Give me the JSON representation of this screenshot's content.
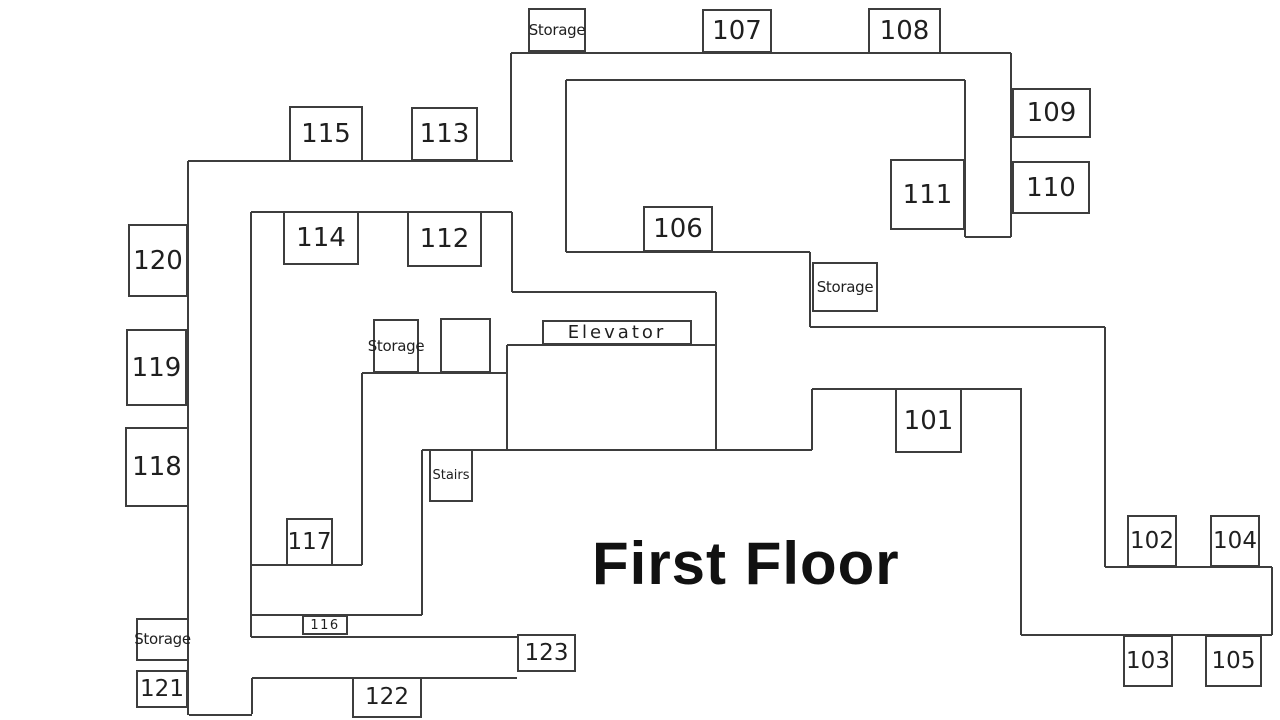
{
  "title": "First Floor",
  "colors": {
    "wall": "#3d3d3d",
    "background": "#ffffff",
    "text": "#1f1f1f"
  },
  "rooms": [
    {
      "id": "storage-top",
      "label": "Storage",
      "variant": "txt",
      "x": 528,
      "y": 8,
      "w": 58,
      "h": 44
    },
    {
      "id": "room-107",
      "label": "107",
      "variant": "num",
      "x": 702,
      "y": 9,
      "w": 70,
      "h": 44
    },
    {
      "id": "room-108",
      "label": "108",
      "variant": "num",
      "x": 868,
      "y": 8,
      "w": 73,
      "h": 46
    },
    {
      "id": "room-109",
      "label": "109",
      "variant": "num",
      "x": 1012,
      "y": 88,
      "w": 79,
      "h": 50
    },
    {
      "id": "room-110",
      "label": "110",
      "variant": "num",
      "x": 1012,
      "y": 161,
      "w": 78,
      "h": 53
    },
    {
      "id": "room-111",
      "label": "111",
      "variant": "num",
      "x": 890,
      "y": 159,
      "w": 75,
      "h": 71
    },
    {
      "id": "room-115",
      "label": "115",
      "variant": "num",
      "x": 289,
      "y": 106,
      "w": 74,
      "h": 56
    },
    {
      "id": "room-113",
      "label": "113",
      "variant": "num",
      "x": 411,
      "y": 107,
      "w": 67,
      "h": 54
    },
    {
      "id": "room-114",
      "label": "114",
      "variant": "num",
      "x": 283,
      "y": 211,
      "w": 76,
      "h": 54
    },
    {
      "id": "room-112",
      "label": "112",
      "variant": "num",
      "x": 407,
      "y": 211,
      "w": 75,
      "h": 56
    },
    {
      "id": "room-106",
      "label": "106",
      "variant": "num",
      "x": 643,
      "y": 206,
      "w": 70,
      "h": 46
    },
    {
      "id": "room-120",
      "label": "120",
      "variant": "num",
      "x": 128,
      "y": 224,
      "w": 60,
      "h": 73
    },
    {
      "id": "room-119",
      "label": "119",
      "variant": "num",
      "x": 126,
      "y": 329,
      "w": 61,
      "h": 77
    },
    {
      "id": "room-118",
      "label": "118",
      "variant": "num",
      "x": 125,
      "y": 427,
      "w": 64,
      "h": 80
    },
    {
      "id": "storage-right",
      "label": "Storage",
      "variant": "txt",
      "x": 812,
      "y": 262,
      "w": 66,
      "h": 50
    },
    {
      "id": "storage-middle",
      "label": "Storage",
      "variant": "txt",
      "x": 373,
      "y": 319,
      "w": 46,
      "h": 54
    },
    {
      "id": "unlabeled-box",
      "label": "",
      "variant": "txt",
      "x": 440,
      "y": 318,
      "w": 51,
      "h": 55
    },
    {
      "id": "elevator",
      "label": "Elevator",
      "variant": "elev",
      "x": 542,
      "y": 320,
      "w": 150,
      "h": 25
    },
    {
      "id": "stairs",
      "label": "Stairs",
      "variant": "txt-sm",
      "x": 429,
      "y": 449,
      "w": 44,
      "h": 53
    },
    {
      "id": "room-101",
      "label": "101",
      "variant": "num",
      "x": 895,
      "y": 388,
      "w": 67,
      "h": 65
    },
    {
      "id": "room-117",
      "label": "117",
      "variant": "num-sm",
      "x": 286,
      "y": 518,
      "w": 47,
      "h": 48
    },
    {
      "id": "room-102",
      "label": "102",
      "variant": "num-sm",
      "x": 1127,
      "y": 515,
      "w": 50,
      "h": 52
    },
    {
      "id": "room-104",
      "label": "104",
      "variant": "num-sm",
      "x": 1210,
      "y": 515,
      "w": 50,
      "h": 52
    },
    {
      "id": "room-103",
      "label": "103",
      "variant": "num-sm",
      "x": 1123,
      "y": 635,
      "w": 50,
      "h": 52
    },
    {
      "id": "room-105",
      "label": "105",
      "variant": "num-sm",
      "x": 1205,
      "y": 635,
      "w": 57,
      "h": 52
    },
    {
      "id": "room-116",
      "label": "116",
      "variant": "tiny",
      "x": 302,
      "y": 615,
      "w": 46,
      "h": 20
    },
    {
      "id": "storage-bottom",
      "label": "Storage",
      "variant": "txt",
      "x": 136,
      "y": 618,
      "w": 53,
      "h": 43
    },
    {
      "id": "room-121",
      "label": "121",
      "variant": "num-sm",
      "x": 136,
      "y": 670,
      "w": 52,
      "h": 38
    },
    {
      "id": "room-122",
      "label": "122",
      "variant": "num-sm",
      "x": 352,
      "y": 677,
      "w": 70,
      "h": 41
    },
    {
      "id": "room-123",
      "label": "123",
      "variant": "num-sm",
      "x": 517,
      "y": 634,
      "w": 59,
      "h": 38
    }
  ],
  "walls": [
    [
      188,
      161,
      513,
      161
    ],
    [
      188,
      161,
      188,
      715
    ],
    [
      251,
      212,
      512,
      212
    ],
    [
      251,
      212,
      251,
      637
    ],
    [
      511,
      53,
      511,
      161
    ],
    [
      511,
      53,
      1011,
      53
    ],
    [
      1011,
      53,
      1011,
      237
    ],
    [
      965,
      237,
      1011,
      237
    ],
    [
      965,
      80,
      965,
      237
    ],
    [
      566,
      80,
      965,
      80
    ],
    [
      566,
      80,
      566,
      252
    ],
    [
      566,
      252,
      810,
      252
    ],
    [
      512,
      212,
      512,
      292
    ],
    [
      512,
      292,
      716,
      292
    ],
    [
      716,
      292,
      716,
      450
    ],
    [
      507,
      345,
      716,
      345
    ],
    [
      507,
      345,
      507,
      450
    ],
    [
      422,
      450,
      812,
      450
    ],
    [
      810,
      252,
      810,
      327
    ],
    [
      810,
      327,
      1105,
      327
    ],
    [
      1105,
      327,
      1105,
      567
    ],
    [
      1105,
      567,
      1272,
      567
    ],
    [
      1272,
      567,
      1272,
      635
    ],
    [
      1021,
      635,
      1272,
      635
    ],
    [
      1021,
      388,
      1021,
      635
    ],
    [
      812,
      389,
      1021,
      389
    ],
    [
      812,
      389,
      812,
      450
    ],
    [
      362,
      373,
      507,
      373
    ],
    [
      362,
      373,
      362,
      565
    ],
    [
      251,
      565,
      362,
      565
    ],
    [
      422,
      450,
      422,
      615
    ],
    [
      251,
      615,
      422,
      615
    ],
    [
      251,
      637,
      517,
      637
    ],
    [
      252,
      678,
      517,
      678
    ],
    [
      252,
      678,
      252,
      714
    ],
    [
      189,
      715,
      252,
      715
    ]
  ]
}
